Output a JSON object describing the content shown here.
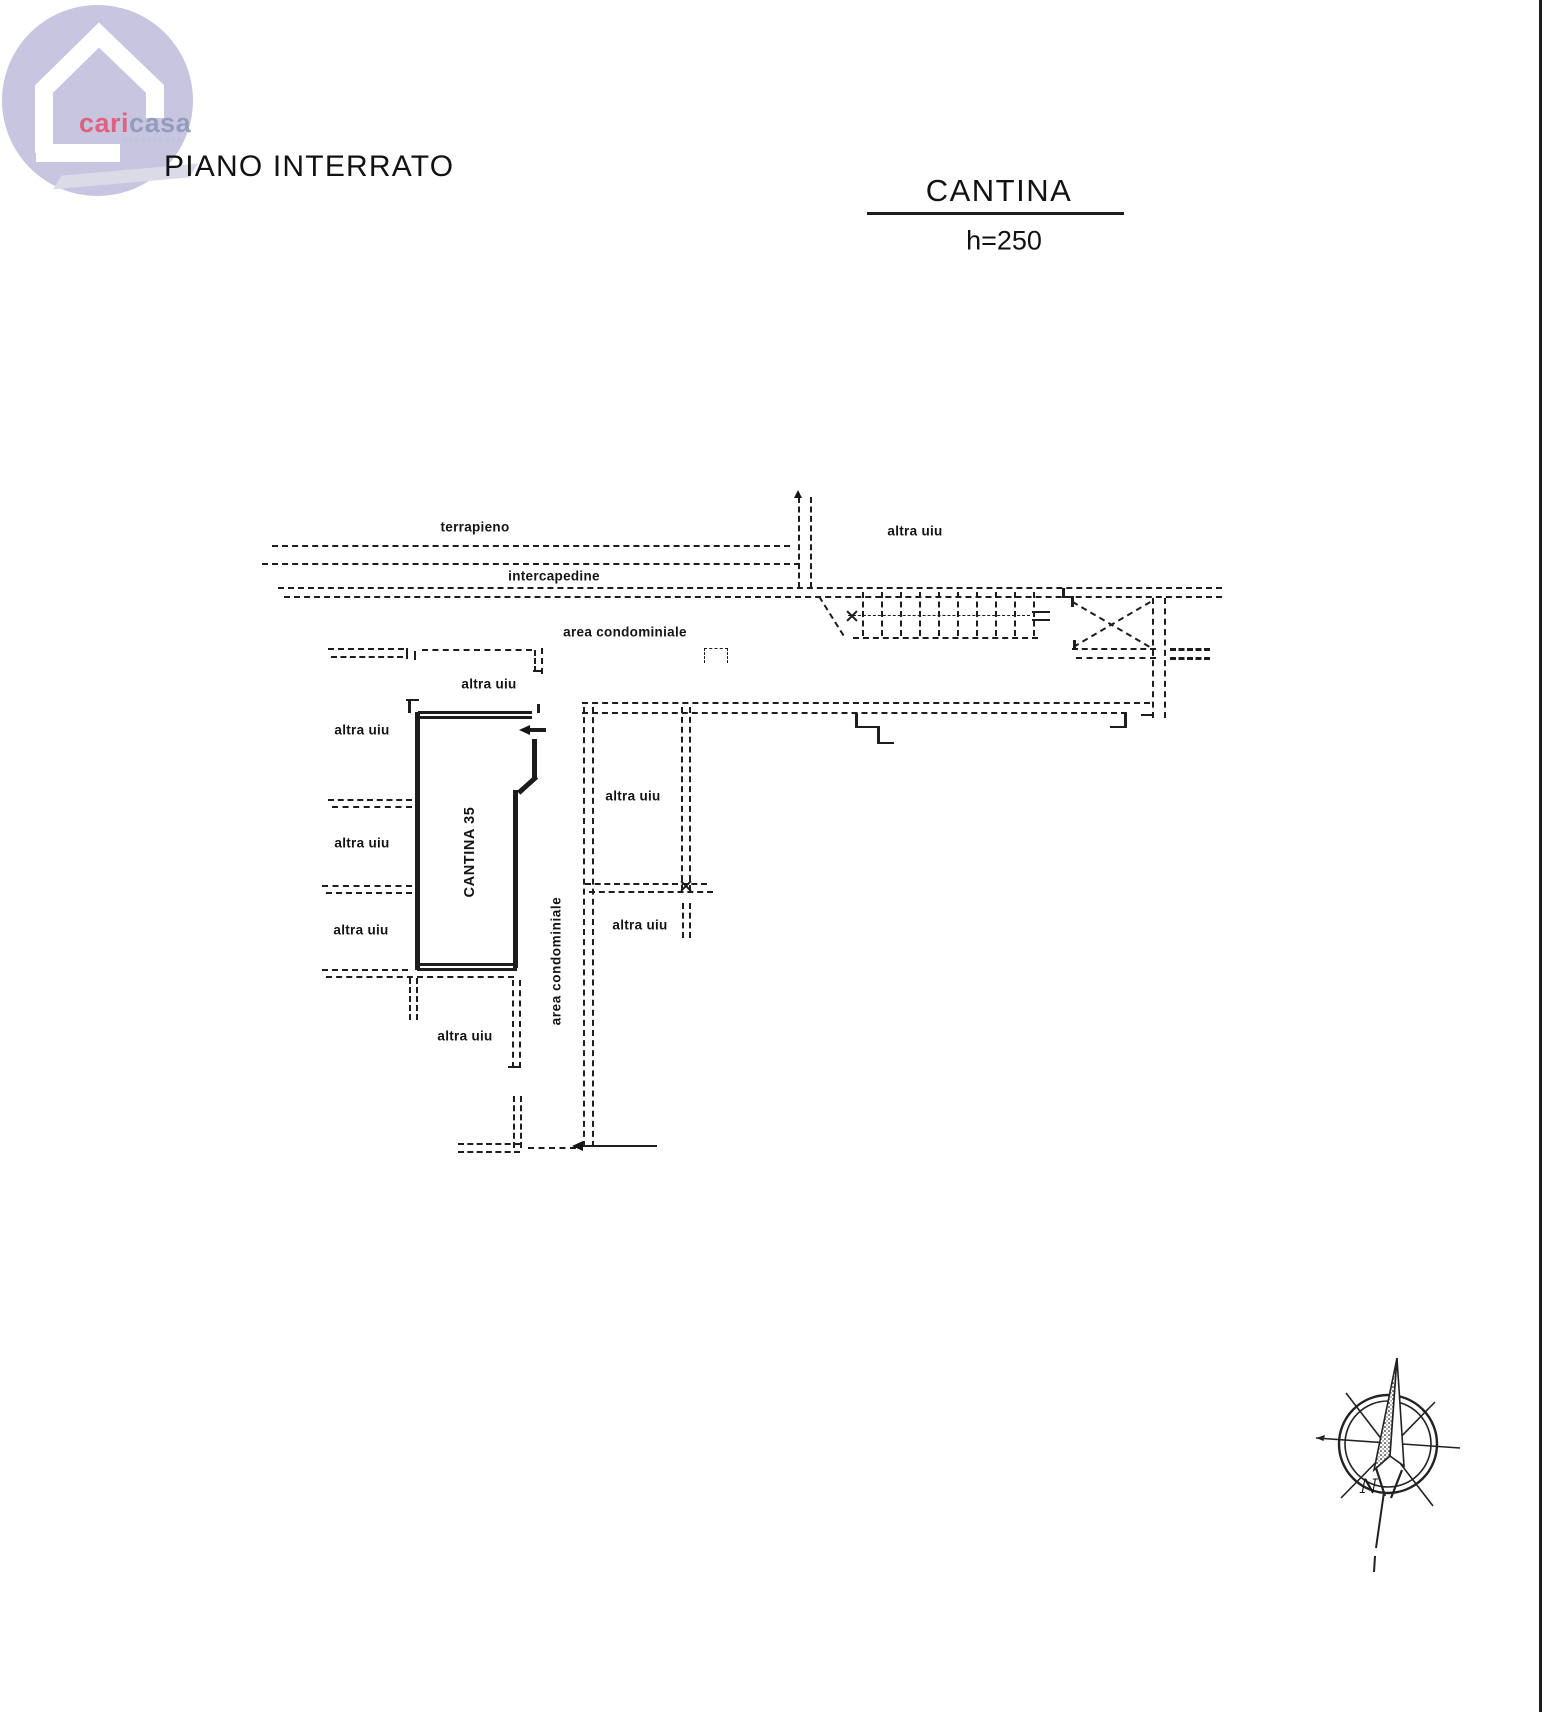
{
  "logo": {
    "brand_cari": "cari",
    "brand_casa": "casa"
  },
  "titles": {
    "floor": "PIANO INTERRATO",
    "room": "CANTINA",
    "height": "h=250"
  },
  "plan_labels": {
    "terrapieno": "terrapieno",
    "intercapedine": "intercapedine",
    "area_condominiale": "area condominiale",
    "altra_uiu": "altra uiu",
    "room_name": "CANTINA 35"
  },
  "compass": {
    "north": "N"
  },
  "colors": {
    "ink": "#1d1d1d",
    "logo_circle": "#c7c5e0",
    "brand_cari": "#e0607f",
    "brand_casa": "#939dbb"
  }
}
